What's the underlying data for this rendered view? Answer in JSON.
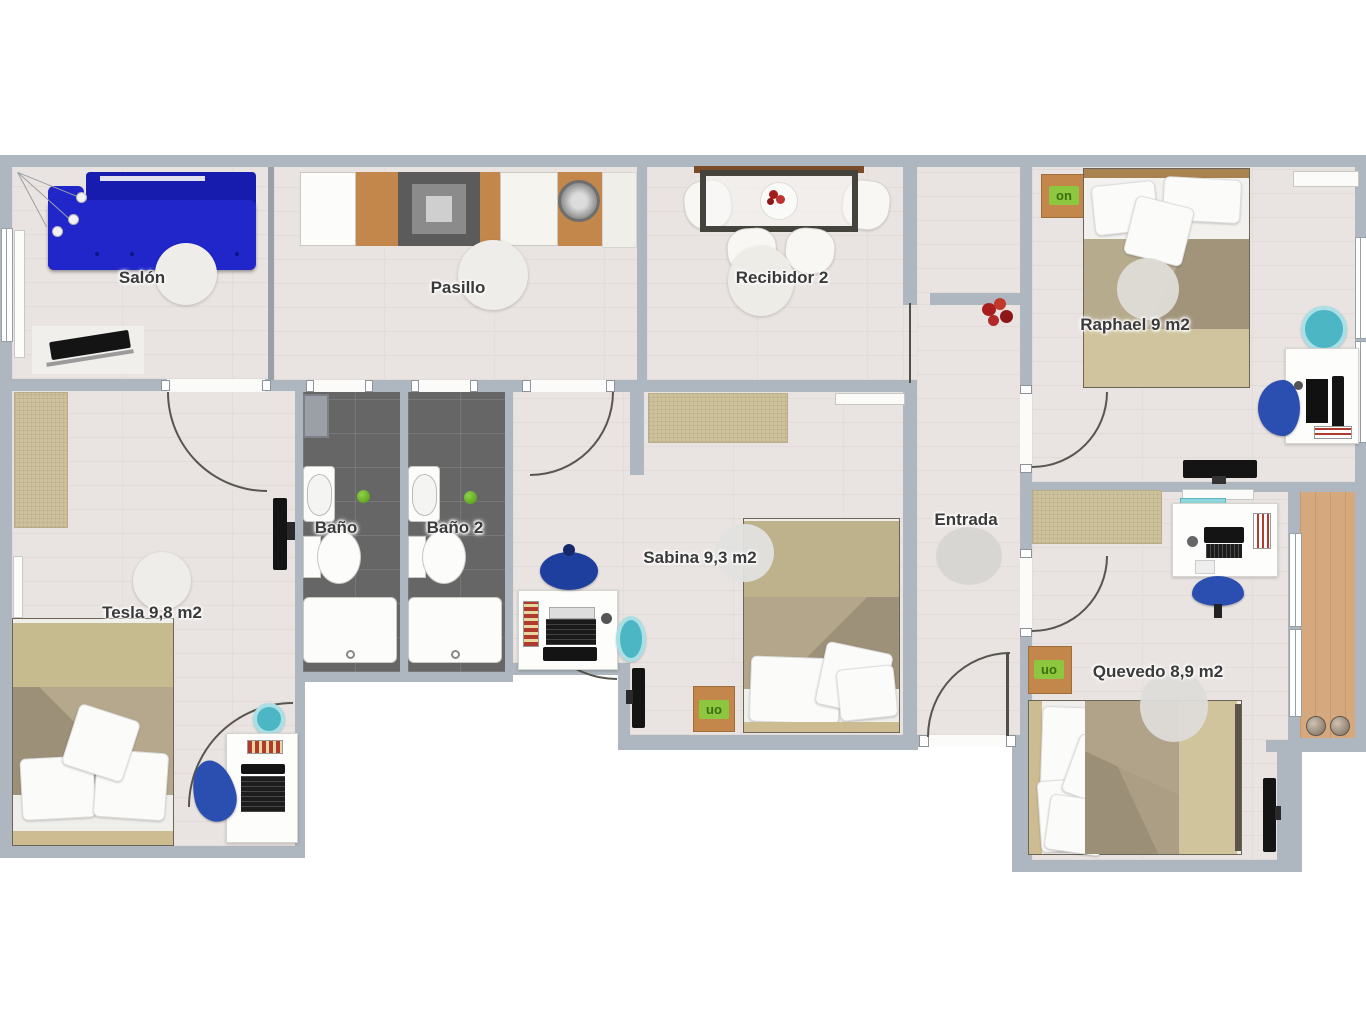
{
  "rooms": {
    "salon": {
      "label": "Salón"
    },
    "pasillo": {
      "label": "Pasillo"
    },
    "recibidor2": {
      "label": "Recibidor 2"
    },
    "raphael": {
      "label": "Raphael 9 m2"
    },
    "tesla": {
      "label": "Tesla 9,8 m2"
    },
    "bano": {
      "label": "Baño"
    },
    "bano2": {
      "label": "Baño 2"
    },
    "sabina": {
      "label": "Sabina 9,3 m2"
    },
    "entrada": {
      "label": "Entrada"
    },
    "quevedo": {
      "label": "Quevedo 8,9 m2"
    }
  },
  "badges": {
    "on": "on",
    "uo": "uo"
  },
  "colors": {
    "wall": "#aeb7bf",
    "floor": "#e9e3e1",
    "bathroom_floor": "#666666",
    "balcony_floor": "#d6a87e",
    "sofa_blue": "#2026c9",
    "office_chair_blue": "#2a4fb0",
    "stool_teal": "#4cb6c4",
    "bed_khaki": "#c6ba8f",
    "bed_blanket": "#a2947c",
    "rug_beige": "#cdc29b",
    "kitchen_wood": "#c3874c",
    "badge_green": "#8dc63f",
    "flowers_red": "#a81e1e"
  }
}
